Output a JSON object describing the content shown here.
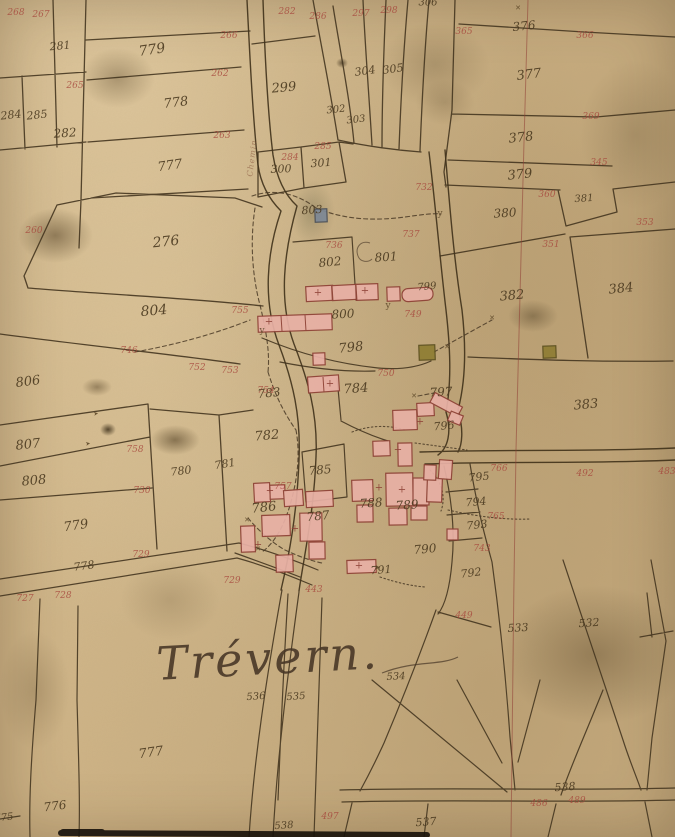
{
  "map": {
    "title": "Cadastral plan of Trévern (hand-drawn)",
    "colors": {
      "paper": "#cdb285",
      "boundary_ink": "#453620",
      "parcel_number_ink": "#4b3a20",
      "revision_number_ink": "#a6453b",
      "building_fill": "#e8b0a5",
      "building_stroke": "#8e4136",
      "special_building_grey": "#7d8896",
      "special_building_olive": "#8f7d33",
      "section_line_red": "#8f3e35"
    }
  },
  "annotations": [
    {
      "text": "281",
      "x": 60,
      "y": 46,
      "cls": "brown",
      "s": 11,
      "r": -5,
      "kind": "parcel-number"
    },
    {
      "text": "779",
      "x": 152,
      "y": 50,
      "cls": "brown",
      "s": 14,
      "r": -8,
      "kind": "parcel-number"
    },
    {
      "text": "284",
      "x": 11,
      "y": 115,
      "cls": "brown",
      "s": 11,
      "r": -6,
      "kind": "parcel-number"
    },
    {
      "text": "285",
      "x": 37,
      "y": 115,
      "cls": "brown",
      "s": 11,
      "r": -6,
      "kind": "parcel-number"
    },
    {
      "text": "282",
      "x": 65,
      "y": 133,
      "cls": "brown",
      "s": 12,
      "r": -4,
      "kind": "parcel-number"
    },
    {
      "text": "778",
      "x": 176,
      "y": 103,
      "cls": "brown",
      "s": 13,
      "r": -7,
      "kind": "parcel-number"
    },
    {
      "text": "777",
      "x": 170,
      "y": 166,
      "cls": "brown",
      "s": 13,
      "r": -8,
      "kind": "parcel-number"
    },
    {
      "text": "299",
      "x": 284,
      "y": 88,
      "cls": "brown",
      "s": 13,
      "r": -5,
      "kind": "parcel-number"
    },
    {
      "text": "302",
      "x": 336,
      "y": 110,
      "cls": "brown",
      "s": 10,
      "r": -6,
      "kind": "parcel-number"
    },
    {
      "text": "303",
      "x": 356,
      "y": 120,
      "cls": "brown",
      "s": 10,
      "r": -6,
      "kind": "parcel-number"
    },
    {
      "text": "304",
      "x": 365,
      "y": 71,
      "cls": "brown",
      "s": 11,
      "r": -8,
      "kind": "parcel-number"
    },
    {
      "text": "305",
      "x": 393,
      "y": 69,
      "cls": "brown",
      "s": 11,
      "r": -8,
      "kind": "parcel-number"
    },
    {
      "text": "306",
      "x": 428,
      "y": 3,
      "cls": "brown",
      "s": 10,
      "r": 0,
      "kind": "parcel-number"
    },
    {
      "text": "300",
      "x": 281,
      "y": 169,
      "cls": "brown",
      "s": 11,
      "r": -2,
      "kind": "parcel-number"
    },
    {
      "text": "301",
      "x": 321,
      "y": 163,
      "cls": "brown",
      "s": 11,
      "r": -4,
      "kind": "parcel-number"
    },
    {
      "text": "376",
      "x": 524,
      "y": 26,
      "cls": "brown",
      "s": 12,
      "r": -6,
      "kind": "parcel-number"
    },
    {
      "text": "377",
      "x": 529,
      "y": 75,
      "cls": "brown",
      "s": 13,
      "r": -7,
      "kind": "parcel-number"
    },
    {
      "text": "378",
      "x": 521,
      "y": 138,
      "cls": "brown",
      "s": 13,
      "r": -6,
      "kind": "parcel-number"
    },
    {
      "text": "379",
      "x": 520,
      "y": 175,
      "cls": "brown",
      "s": 13,
      "r": -6,
      "kind": "parcel-number"
    },
    {
      "text": "380",
      "x": 505,
      "y": 213,
      "cls": "brown",
      "s": 12,
      "r": -4,
      "kind": "parcel-number"
    },
    {
      "text": "381",
      "x": 584,
      "y": 199,
      "cls": "brown",
      "s": 10,
      "r": -4,
      "kind": "parcel-number"
    },
    {
      "text": "382",
      "x": 512,
      "y": 296,
      "cls": "brown",
      "s": 13,
      "r": -5,
      "kind": "parcel-number"
    },
    {
      "text": "384",
      "x": 621,
      "y": 289,
      "cls": "brown",
      "s": 13,
      "r": -6,
      "kind": "parcel-number"
    },
    {
      "text": "383",
      "x": 586,
      "y": 405,
      "cls": "brown",
      "s": 13,
      "r": -5,
      "kind": "parcel-number"
    },
    {
      "text": "276",
      "x": 166,
      "y": 242,
      "cls": "brown",
      "s": 14,
      "r": -6,
      "kind": "parcel-number"
    },
    {
      "text": "803",
      "x": 312,
      "y": 210,
      "cls": "brown",
      "s": 11,
      "r": -4,
      "kind": "parcel-number"
    },
    {
      "text": "802",
      "x": 330,
      "y": 262,
      "cls": "brown",
      "s": 12,
      "r": -5,
      "kind": "parcel-number"
    },
    {
      "text": "801",
      "x": 386,
      "y": 257,
      "cls": "brown",
      "s": 12,
      "r": -4,
      "kind": "parcel-number"
    },
    {
      "text": "800",
      "x": 343,
      "y": 314,
      "cls": "brown",
      "s": 12,
      "r": -3,
      "kind": "parcel-number"
    },
    {
      "text": "798",
      "x": 351,
      "y": 348,
      "cls": "brown",
      "s": 13,
      "r": -6,
      "kind": "parcel-number"
    },
    {
      "text": "799",
      "x": 427,
      "y": 287,
      "cls": "brown",
      "s": 10,
      "r": -5,
      "kind": "parcel-number"
    },
    {
      "text": "797",
      "x": 441,
      "y": 392,
      "cls": "brown",
      "s": 12,
      "r": -3,
      "kind": "parcel-number"
    },
    {
      "text": "796",
      "x": 444,
      "y": 426,
      "cls": "brown",
      "s": 11,
      "r": -5,
      "kind": "parcel-number"
    },
    {
      "text": "804",
      "x": 154,
      "y": 311,
      "cls": "brown",
      "s": 14,
      "r": -5,
      "kind": "parcel-number"
    },
    {
      "text": "806",
      "x": 28,
      "y": 382,
      "cls": "brown",
      "s": 13,
      "r": -7,
      "kind": "parcel-number"
    },
    {
      "text": "807",
      "x": 28,
      "y": 445,
      "cls": "brown",
      "s": 13,
      "r": -6,
      "kind": "parcel-number"
    },
    {
      "text": "808",
      "x": 34,
      "y": 481,
      "cls": "brown",
      "s": 13,
      "r": -5,
      "kind": "parcel-number"
    },
    {
      "text": "779",
      "x": 76,
      "y": 526,
      "cls": "brown",
      "s": 13,
      "r": -8,
      "kind": "parcel-number"
    },
    {
      "text": "778",
      "x": 84,
      "y": 566,
      "cls": "brown",
      "s": 11,
      "r": -8,
      "kind": "parcel-number"
    },
    {
      "text": "780",
      "x": 181,
      "y": 471,
      "cls": "brown",
      "s": 11,
      "r": -7,
      "kind": "parcel-number"
    },
    {
      "text": "781",
      "x": 225,
      "y": 464,
      "cls": "brown",
      "s": 11,
      "r": -9,
      "kind": "parcel-number"
    },
    {
      "text": "782",
      "x": 267,
      "y": 436,
      "cls": "brown",
      "s": 13,
      "r": -5,
      "kind": "parcel-number"
    },
    {
      "text": "783",
      "x": 269,
      "y": 393,
      "cls": "brown",
      "s": 12,
      "r": -6,
      "kind": "parcel-number"
    },
    {
      "text": "784",
      "x": 356,
      "y": 389,
      "cls": "brown",
      "s": 13,
      "r": -4,
      "kind": "parcel-number"
    },
    {
      "text": "785",
      "x": 320,
      "y": 470,
      "cls": "brown",
      "s": 12,
      "r": -5,
      "kind": "parcel-number"
    },
    {
      "text": "786",
      "x": 264,
      "y": 508,
      "cls": "brown",
      "s": 13,
      "r": -6,
      "kind": "parcel-number"
    },
    {
      "text": "787",
      "x": 318,
      "y": 516,
      "cls": "brown",
      "s": 12,
      "r": -6,
      "kind": "parcel-number"
    },
    {
      "text": "788",
      "x": 371,
      "y": 503,
      "cls": "brown",
      "s": 12,
      "r": -4,
      "kind": "parcel-number"
    },
    {
      "text": "789",
      "x": 407,
      "y": 505,
      "cls": "brown",
      "s": 12,
      "r": -4,
      "kind": "parcel-number"
    },
    {
      "text": "790",
      "x": 425,
      "y": 549,
      "cls": "brown",
      "s": 12,
      "r": -5,
      "kind": "parcel-number"
    },
    {
      "text": "791",
      "x": 381,
      "y": 570,
      "cls": "brown",
      "s": 11,
      "r": -4,
      "kind": "parcel-number"
    },
    {
      "text": "795",
      "x": 479,
      "y": 477,
      "cls": "brown",
      "s": 11,
      "r": -6,
      "kind": "parcel-number"
    },
    {
      "text": "794",
      "x": 476,
      "y": 502,
      "cls": "brown",
      "s": 11,
      "r": -5,
      "kind": "parcel-number"
    },
    {
      "text": "793",
      "x": 477,
      "y": 525,
      "cls": "brown",
      "s": 11,
      "r": -6,
      "kind": "parcel-number"
    },
    {
      "text": "792",
      "x": 471,
      "y": 573,
      "cls": "brown",
      "s": 11,
      "r": -7,
      "kind": "parcel-number"
    },
    {
      "text": "533",
      "x": 518,
      "y": 628,
      "cls": "brown",
      "s": 11,
      "r": -3,
      "kind": "parcel-number"
    },
    {
      "text": "532",
      "x": 589,
      "y": 623,
      "cls": "brown",
      "s": 11,
      "r": -4,
      "kind": "parcel-number"
    },
    {
      "text": "534",
      "x": 396,
      "y": 677,
      "cls": "brown",
      "s": 10,
      "r": -3,
      "kind": "parcel-number"
    },
    {
      "text": "536",
      "x": 256,
      "y": 697,
      "cls": "brown",
      "s": 10,
      "r": -4,
      "kind": "parcel-number"
    },
    {
      "text": "535",
      "x": 296,
      "y": 697,
      "cls": "brown",
      "s": 10,
      "r": -4,
      "kind": "parcel-number"
    },
    {
      "text": "777",
      "x": 151,
      "y": 753,
      "cls": "brown",
      "s": 13,
      "r": -8,
      "kind": "parcel-number"
    },
    {
      "text": "776",
      "x": 55,
      "y": 806,
      "cls": "brown",
      "s": 12,
      "r": -7,
      "kind": "parcel-number"
    },
    {
      "text": "775",
      "x": 4,
      "y": 818,
      "cls": "brown",
      "s": 10,
      "r": -6,
      "kind": "parcel-number"
    },
    {
      "text": "538",
      "x": 565,
      "y": 787,
      "cls": "brown",
      "s": 11,
      "r": -4,
      "kind": "parcel-number"
    },
    {
      "text": "538",
      "x": 284,
      "y": 826,
      "cls": "brown",
      "s": 10,
      "r": -4,
      "kind": "parcel-number"
    },
    {
      "text": "537",
      "x": 426,
      "y": 822,
      "cls": "brown",
      "s": 11,
      "r": -4,
      "kind": "parcel-number"
    },
    {
      "text": "268",
      "x": 16,
      "y": 13,
      "cls": "red",
      "kind": "revision-number"
    },
    {
      "text": "267",
      "x": 41,
      "y": 15,
      "cls": "red",
      "kind": "revision-number"
    },
    {
      "text": "266",
      "x": 229,
      "y": 36,
      "cls": "red",
      "kind": "revision-number"
    },
    {
      "text": "265",
      "x": 75,
      "y": 86,
      "cls": "red",
      "kind": "revision-number"
    },
    {
      "text": "262",
      "x": 220,
      "y": 74,
      "cls": "red",
      "kind": "revision-number"
    },
    {
      "text": "263",
      "x": 222,
      "y": 136,
      "cls": "red",
      "kind": "revision-number"
    },
    {
      "text": "282",
      "x": 287,
      "y": 12,
      "cls": "red",
      "kind": "revision-number"
    },
    {
      "text": "286",
      "x": 318,
      "y": 17,
      "cls": "red",
      "kind": "revision-number"
    },
    {
      "text": "297",
      "x": 361,
      "y": 14,
      "cls": "red",
      "kind": "revision-number"
    },
    {
      "text": "298",
      "x": 389,
      "y": 11,
      "cls": "red",
      "kind": "revision-number"
    },
    {
      "text": "365",
      "x": 464,
      "y": 32,
      "cls": "red",
      "kind": "revision-number"
    },
    {
      "text": "366",
      "x": 585,
      "y": 36,
      "cls": "red",
      "kind": "revision-number"
    },
    {
      "text": "369",
      "x": 591,
      "y": 117,
      "cls": "red",
      "kind": "revision-number"
    },
    {
      "text": "345",
      "x": 599,
      "y": 163,
      "cls": "red",
      "kind": "revision-number"
    },
    {
      "text": "353",
      "x": 645,
      "y": 223,
      "cls": "red",
      "kind": "revision-number"
    },
    {
      "text": "360",
      "x": 547,
      "y": 195,
      "cls": "red",
      "kind": "revision-number"
    },
    {
      "text": "351",
      "x": 551,
      "y": 245,
      "cls": "red",
      "kind": "revision-number"
    },
    {
      "text": "260",
      "x": 34,
      "y": 231,
      "cls": "red",
      "kind": "revision-number"
    },
    {
      "text": "755",
      "x": 240,
      "y": 311,
      "cls": "red",
      "kind": "revision-number"
    },
    {
      "text": "746",
      "x": 129,
      "y": 351,
      "cls": "red",
      "kind": "revision-number"
    },
    {
      "text": "752",
      "x": 197,
      "y": 368,
      "cls": "red",
      "kind": "revision-number"
    },
    {
      "text": "753",
      "x": 230,
      "y": 371,
      "cls": "red",
      "kind": "revision-number"
    },
    {
      "text": "754",
      "x": 266,
      "y": 391,
      "cls": "red",
      "kind": "revision-number"
    },
    {
      "text": "736",
      "x": 334,
      "y": 246,
      "cls": "red",
      "kind": "revision-number"
    },
    {
      "text": "737",
      "x": 411,
      "y": 235,
      "cls": "red",
      "kind": "revision-number"
    },
    {
      "text": "732",
      "x": 424,
      "y": 188,
      "cls": "red",
      "kind": "revision-number"
    },
    {
      "text": "749",
      "x": 413,
      "y": 315,
      "cls": "red",
      "kind": "revision-number"
    },
    {
      "text": "284",
      "x": 290,
      "y": 158,
      "cls": "red",
      "kind": "revision-number"
    },
    {
      "text": "285",
      "x": 323,
      "y": 147,
      "cls": "red",
      "kind": "revision-number"
    },
    {
      "text": "750",
      "x": 386,
      "y": 374,
      "cls": "red",
      "kind": "revision-number"
    },
    {
      "text": "757",
      "x": 283,
      "y": 487,
      "cls": "red",
      "kind": "revision-number"
    },
    {
      "text": "758",
      "x": 135,
      "y": 450,
      "cls": "red",
      "kind": "revision-number"
    },
    {
      "text": "730",
      "x": 142,
      "y": 491,
      "cls": "red",
      "kind": "revision-number"
    },
    {
      "text": "729",
      "x": 141,
      "y": 555,
      "cls": "red",
      "kind": "revision-number"
    },
    {
      "text": "729",
      "x": 232,
      "y": 581,
      "cls": "red",
      "kind": "revision-number"
    },
    {
      "text": "727",
      "x": 25,
      "y": 599,
      "cls": "red",
      "kind": "revision-number"
    },
    {
      "text": "728",
      "x": 63,
      "y": 596,
      "cls": "red",
      "kind": "revision-number"
    },
    {
      "text": "766",
      "x": 499,
      "y": 469,
      "cls": "red",
      "kind": "revision-number"
    },
    {
      "text": "765",
      "x": 496,
      "y": 517,
      "cls": "red",
      "kind": "revision-number"
    },
    {
      "text": "743",
      "x": 482,
      "y": 549,
      "cls": "red",
      "kind": "revision-number"
    },
    {
      "text": "492",
      "x": 585,
      "y": 474,
      "cls": "red",
      "kind": "revision-number"
    },
    {
      "text": "449",
      "x": 464,
      "y": 616,
      "cls": "red",
      "kind": "revision-number"
    },
    {
      "text": "443",
      "x": 314,
      "y": 590,
      "cls": "red",
      "kind": "revision-number"
    },
    {
      "text": "486",
      "x": 539,
      "y": 804,
      "cls": "red",
      "kind": "revision-number"
    },
    {
      "text": "489",
      "x": 577,
      "y": 801,
      "cls": "red",
      "kind": "revision-number"
    },
    {
      "text": "497",
      "x": 330,
      "y": 817,
      "cls": "red",
      "kind": "revision-number"
    },
    {
      "text": "483",
      "x": 667,
      "y": 472,
      "cls": "red",
      "kind": "revision-number"
    },
    {
      "text": "✕",
      "x": 518,
      "y": 8,
      "cls": "mark",
      "kind": "survey-mark"
    },
    {
      "text": "✕",
      "x": 414,
      "y": 396,
      "cls": "mark",
      "kind": "survey-mark"
    },
    {
      "text": "✕",
      "x": 447,
      "y": 347,
      "cls": "mark",
      "kind": "survey-mark"
    },
    {
      "text": "✕",
      "x": 492,
      "y": 318,
      "cls": "mark",
      "kind": "survey-mark"
    },
    {
      "text": "✕",
      "x": 247,
      "y": 520,
      "cls": "mark",
      "kind": "survey-mark"
    },
    {
      "text": "✕",
      "x": 258,
      "y": 549,
      "cls": "mark",
      "kind": "survey-mark"
    },
    {
      "text": "y",
      "x": 262,
      "y": 331,
      "cls": "mark",
      "s": 9,
      "kind": "survey-mark"
    },
    {
      "text": "y",
      "x": 388,
      "y": 306,
      "cls": "mark",
      "s": 9,
      "kind": "survey-mark"
    },
    {
      "text": "y",
      "x": 440,
      "y": 214,
      "cls": "mark",
      "s": 9,
      "kind": "survey-mark"
    },
    {
      "text": "➤",
      "x": 96,
      "y": 414,
      "cls": "mark",
      "s": 6,
      "r": -10,
      "kind": "survey-mark"
    },
    {
      "text": "➤",
      "x": 88,
      "y": 444,
      "cls": "mark",
      "s": 6,
      "r": -10,
      "kind": "survey-mark"
    },
    {
      "text": "▸",
      "x": 378,
      "y": 567,
      "cls": "mark",
      "s": 8,
      "kind": "survey-mark"
    },
    {
      "text": "+",
      "x": 318,
      "y": 293,
      "cls": "markred",
      "kind": "survey-mark"
    },
    {
      "text": "+",
      "x": 365,
      "y": 291,
      "cls": "markred",
      "kind": "survey-mark"
    },
    {
      "text": "+",
      "x": 269,
      "y": 322,
      "cls": "markred",
      "kind": "survey-mark"
    },
    {
      "text": "+",
      "x": 379,
      "y": 488,
      "cls": "markred",
      "kind": "survey-mark"
    },
    {
      "text": "+",
      "x": 402,
      "y": 490,
      "cls": "markred",
      "kind": "survey-mark"
    },
    {
      "text": "+",
      "x": 295,
      "y": 529,
      "cls": "markred",
      "kind": "survey-mark"
    },
    {
      "text": "+",
      "x": 270,
      "y": 491,
      "cls": "markred",
      "kind": "survey-mark"
    },
    {
      "text": "+",
      "x": 258,
      "y": 545,
      "cls": "markred",
      "kind": "survey-mark"
    },
    {
      "text": "+",
      "x": 359,
      "y": 566,
      "cls": "markred",
      "kind": "survey-mark"
    },
    {
      "text": "+",
      "x": 420,
      "y": 422,
      "cls": "markred",
      "kind": "survey-mark"
    },
    {
      "text": "+",
      "x": 398,
      "y": 450,
      "cls": "markred",
      "kind": "survey-mark"
    },
    {
      "text": "+",
      "x": 330,
      "y": 384,
      "cls": "markred",
      "kind": "survey-mark"
    },
    {
      "text": "Trévern.",
      "x": 268,
      "y": 658,
      "cls": "place",
      "r": -3,
      "kind": "place-name-label"
    },
    {
      "text": "Chemin",
      "x": 252,
      "y": 158,
      "cls": "road",
      "r": -83,
      "kind": "road-name-label"
    }
  ]
}
